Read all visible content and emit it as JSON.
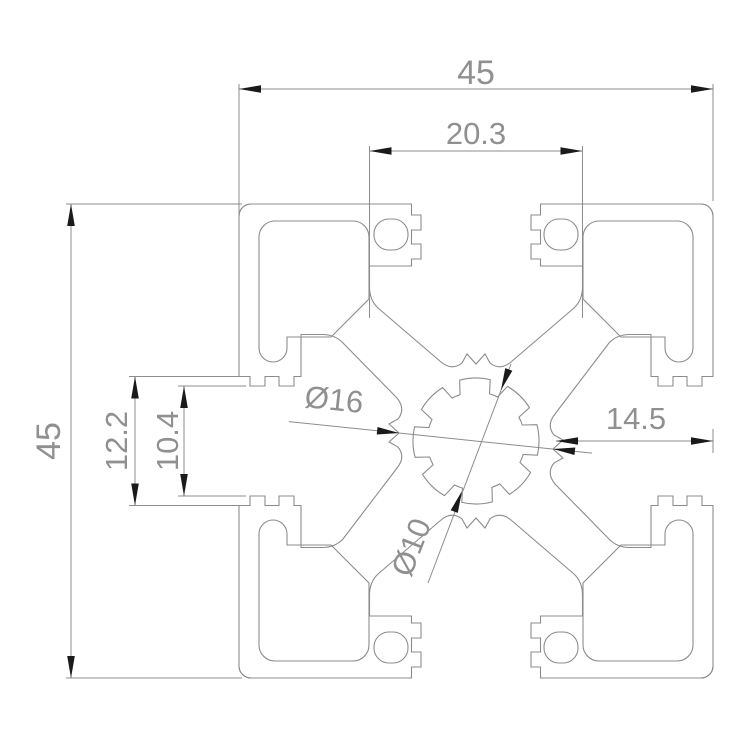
{
  "drawing": {
    "title": "45x45 extrusion profile cross-section",
    "units": "mm",
    "colors": {
      "background": "#ffffff",
      "profile_line": "#8c8c8c",
      "dimension_line": "#8c8c8c",
      "arrow": "#1a1a1a",
      "text": "#909090"
    },
    "dimensions": {
      "overall_width": {
        "label": "45",
        "value": 45
      },
      "overall_height": {
        "label": "45",
        "value": 45
      },
      "slot_cavity_width": {
        "label": "20.3",
        "value": 20.3
      },
      "slot_recess_width": {
        "label": "12.2",
        "value": 12.2
      },
      "slot_opening_width": {
        "label": "10.4",
        "value": 10.4
      },
      "web_to_face": {
        "label": "14.5",
        "value": 14.5
      },
      "bore_outer": {
        "label": "Ø16",
        "value": 16
      },
      "bore_inner": {
        "label": "Ø10",
        "value": 10
      }
    }
  }
}
